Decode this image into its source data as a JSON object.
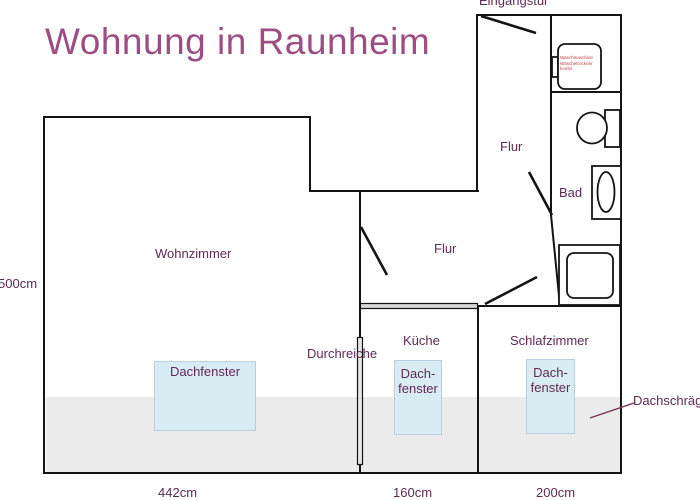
{
  "title": "Wohnung in Raunheim",
  "rooms": {
    "wohnzimmer": "Wohnzimmer",
    "flur_top": "Flur",
    "flur_main": "Flur",
    "bad": "Bad",
    "kueche": "Küche",
    "schlafzimmer": "Schlafzimmer"
  },
  "annotations": {
    "eingangstuer": "Eingangstür",
    "durchreiche": "Durchreiche",
    "dachschraege": "Dachschräge",
    "dachfenster": "Dachfenster",
    "dachfenster_line1": "Dach-",
    "dachfenster_line2": "fenster"
  },
  "appliance": {
    "line1": "Waschmaschine",
    "line2": "Wäschetrockner",
    "line3": "kombi"
  },
  "measurements": {
    "height_left": "500cm",
    "width_wohnzimmer": "442cm",
    "width_kueche": "160cm",
    "width_schlafzimmer": "200cm"
  },
  "colors": {
    "title": "#9e4d82",
    "label": "#5e2a56",
    "wall": "#141414",
    "skylight_fill": "#d9ecf4",
    "skylight_border": "#b6d0dd",
    "roof_band": "#ebebeb",
    "appliance_text": "#c03a3a"
  }
}
